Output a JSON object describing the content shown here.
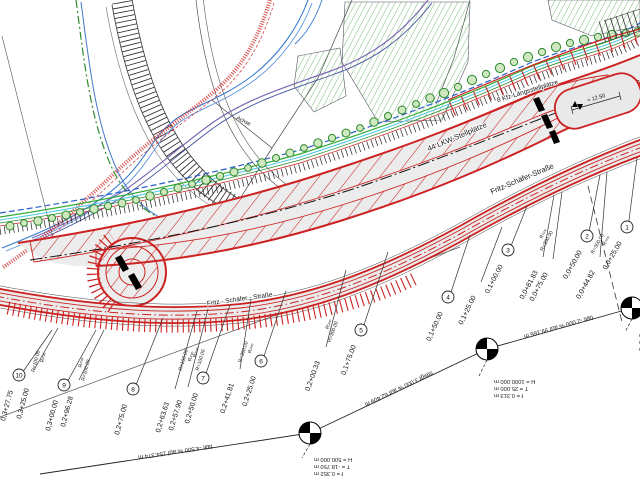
{
  "plan": {
    "labels": {
      "lkw": "44 LKW-Stellplätze",
      "kfz": "8 Kfz-Längsstellplätze",
      "street1": "Fritz-Schäfer-Straße",
      "street2": "Fritz - Schäfer - Straße",
      "achse": "Achse",
      "dim": "≈ 12.50"
    },
    "gradients": {
      "g1": "fällt -4.500 % auf 154.374 m",
      "g2": "steigt 3.000 % auf 62.409 m",
      "g3": "fällt -2.000 % auf 99.166 m"
    },
    "blocks": {
      "bm1": {
        "h": "H = 500.000 m",
        "t": "T = -18.750 m",
        "f": "f = 0.352 m"
      },
      "bm2": {
        "h": "H = 1000.000 m",
        "t": "T = 25.000 m",
        "f": "f = 0.313 m"
      },
      "bm3": {
        "h": "H = 1000.000 m",
        "t": "T = -5.000 m",
        "f": "f = 0.013 m"
      }
    },
    "stations": [
      {
        "num": "10",
        "label": "0,3+27.75"
      },
      {
        "label": "0,3+25.00",
        "r1": "R=100.00",
        "r2": "R=∞"
      },
      {
        "num": "9",
        "label": "0,3+00.00"
      },
      {
        "label": "0,2+96.28",
        "r1": "R=∞",
        "r2": "R=100.00"
      },
      {
        "num": "8",
        "label": "0,2+75.00"
      },
      {
        "label": "0,2+63.63",
        "r1": "R=100.00",
        "r2": "R=∞"
      },
      {
        "label": "0,2+57.90",
        "r1": "R=∞",
        "r2": "R=100.00"
      },
      {
        "num": "7",
        "label": "0,2+50.00"
      },
      {
        "label": "0,2+41.81",
        "r1": "R=300.00",
        "r2": "R=∞"
      },
      {
        "num": "6",
        "label": "0,2+25.00"
      },
      {
        "label": "0,2+00.33",
        "r1": "R=∞",
        "r2": "R=300.00"
      },
      {
        "num": "5",
        "label": "0,1+75.00"
      },
      {
        "num": "4",
        "label": "0,1+50.00"
      },
      {
        "label": "0,1+25.00"
      },
      {
        "num": "3",
        "label": "0,1+00.00"
      },
      {
        "label": "0,0+81.83",
        "r1": "R=∞",
        "r2": "R=300.00"
      },
      {
        "label": "0,0+75.00"
      },
      {
        "num": "2",
        "label": "0,0+50.00"
      },
      {
        "label": "0,0+44.82",
        "r1": "R=300.00",
        "r2": "R=∞"
      },
      {
        "num": "1",
        "label": "0,0+25.00"
      }
    ],
    "colors": {
      "construction_red": "#cc2222",
      "vegetation_green": "#2e8b2e",
      "water_blue": "#3a7bd0",
      "utility_cyan": "#55cce8",
      "utility_purple": "#7b68b5",
      "surface_gray": "#ececec"
    }
  }
}
